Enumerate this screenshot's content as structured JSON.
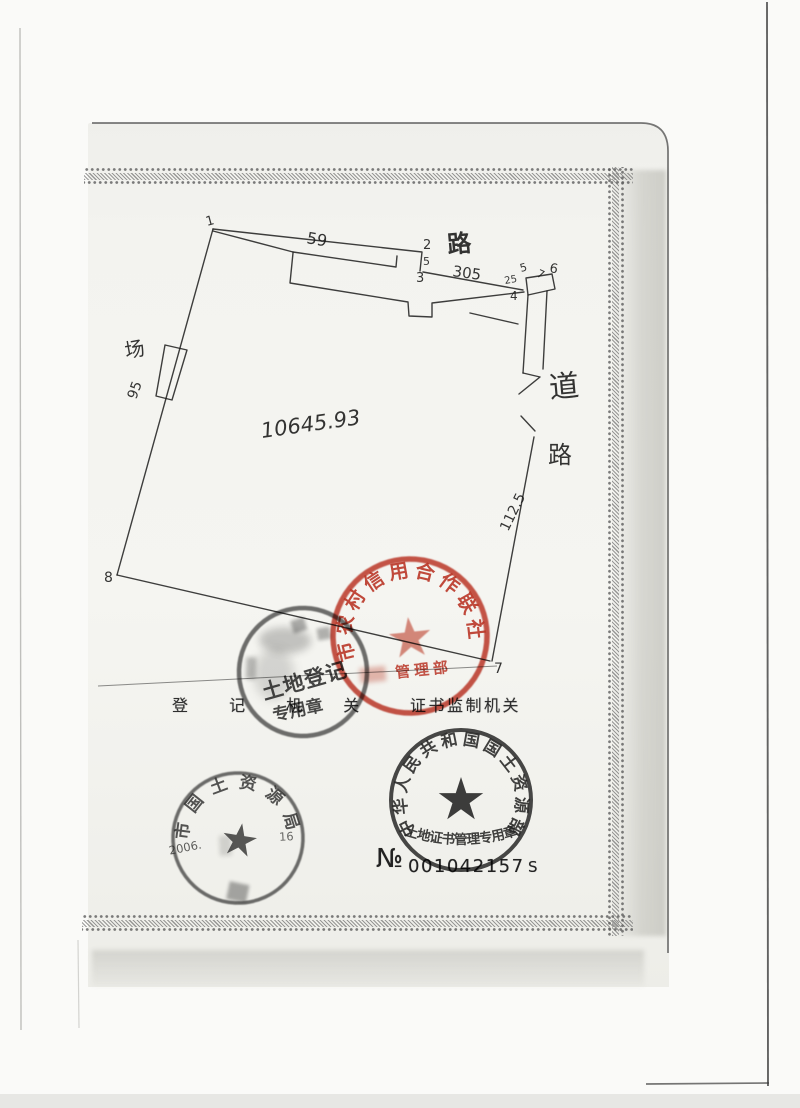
{
  "glyphs": {
    "star": "★"
  },
  "scan": {
    "form_labels": {
      "registration_authority": "登 记 机 关",
      "certificate_supervision": "证书监制机关"
    },
    "serial": {
      "prefix": "№",
      "number": "001042157",
      "suffix": "S"
    }
  },
  "parcel": {
    "area_value": "10645.93",
    "vertex_labels": {
      "v1": "1",
      "v2": "2",
      "v3": "3",
      "v4": "4",
      "v5": "5",
      "v6": "6",
      "v7": "7",
      "v8": "8"
    },
    "measurements": {
      "edge_1_2": "59",
      "edge_2_3": "5",
      "edge_3_4": "305",
      "near_v4": "25",
      "edge_5_6": "7",
      "right_edge": "112.5",
      "left_annex": "95"
    },
    "labels": {
      "road_top": "路",
      "road_right_upper": "道",
      "road_right_lower": "路",
      "left_annex": "场"
    }
  },
  "stamps": {
    "credit_union_red": {
      "arc_text": "市农村信用合作联社",
      "bottom_text": "管理部",
      "ink_color": "#c2392a"
    },
    "land_registration_black": {
      "line1": "土地登记",
      "line2": "专用章"
    },
    "land_resources_bureau": {
      "arc_text": "市国土资源局",
      "date_left": "2006.",
      "date_right": "16"
    },
    "ministry": {
      "arc_text": "中华人民共和国国土资源部",
      "inner_arc_text": "土地证书管理专用章"
    }
  }
}
